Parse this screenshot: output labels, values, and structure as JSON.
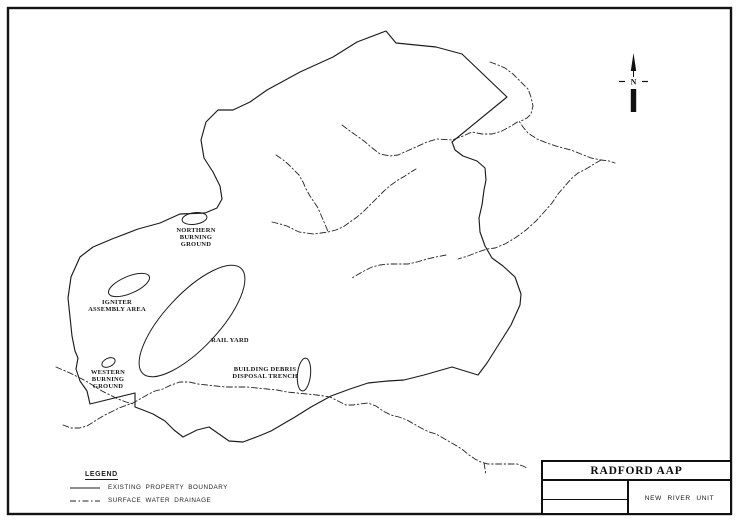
{
  "colors": {
    "ink": "#1a1a1a",
    "background": "#ffffff"
  },
  "title_block": {
    "title": "RADFORD AAP",
    "unit": "NEW RIVER UNIT"
  },
  "north_indicator": {
    "letter": "N"
  },
  "legend": {
    "heading": "LEGEND",
    "items": [
      {
        "label": "EXISTING PROPERTY BOUNDARY",
        "line_style": "solid"
      },
      {
        "label": "SURFACE WATER DRAINAGE",
        "line_style": "dash-dot"
      }
    ]
  },
  "features": {
    "northern_burning_ground": {
      "lines": [
        "NORTHERN",
        "BURNING",
        "GROUND"
      ]
    },
    "igniter_assembly_area": {
      "lines": [
        "IGNITER",
        "ASSEMBLY AREA"
      ]
    },
    "rail_yard": {
      "lines": [
        "RAIL YARD"
      ]
    },
    "western_burning_ground": {
      "lines": [
        "WESTERN",
        "BURNING",
        "GROUND"
      ]
    },
    "building_debris_disposal_trench": {
      "lines": [
        "BUILDING DEBRIS",
        "DISPOSAL TRENCH"
      ]
    }
  }
}
